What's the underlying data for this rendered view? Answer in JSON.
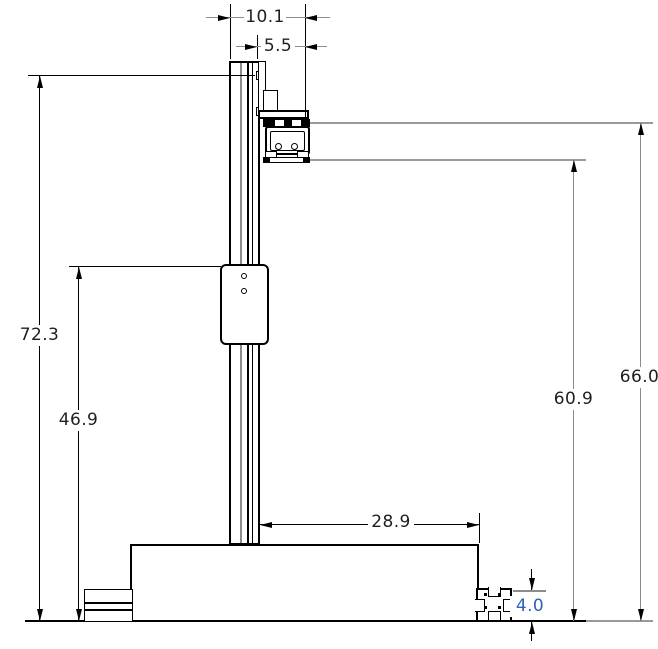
{
  "dims": {
    "top_width": "10.1",
    "top_offset": "5.5",
    "overall_height": "72.3",
    "mount_height": "46.9",
    "base_width": "28.9",
    "arm_lower_height": "60.9",
    "arm_upper_height": "66.0",
    "foot_height": "4.0"
  },
  "colors": {
    "edge_line": "#000000",
    "projection_line": "#9a9a9a",
    "dimension_text": "#1f1f1f",
    "selected_dimension_text": "#2d62bd",
    "background": "#ffffff"
  }
}
